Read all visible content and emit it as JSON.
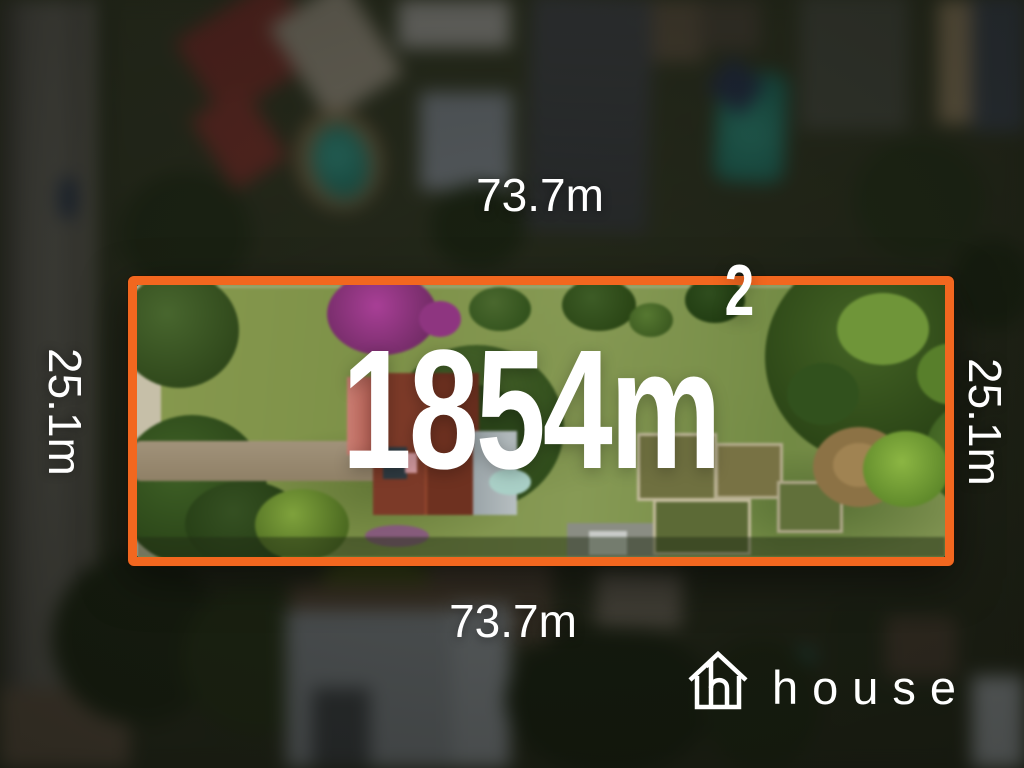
{
  "dimensions": {
    "top": "73.7m",
    "bottom": "73.7m",
    "left": "25.1m",
    "right": "25.1m"
  },
  "area": {
    "value": "1854m",
    "superscript": "2"
  },
  "brand": {
    "name": "house",
    "icon": "house-outline-icon"
  },
  "colors": {
    "boundary": "#F2671F",
    "label_text": "#FFFFFF"
  }
}
